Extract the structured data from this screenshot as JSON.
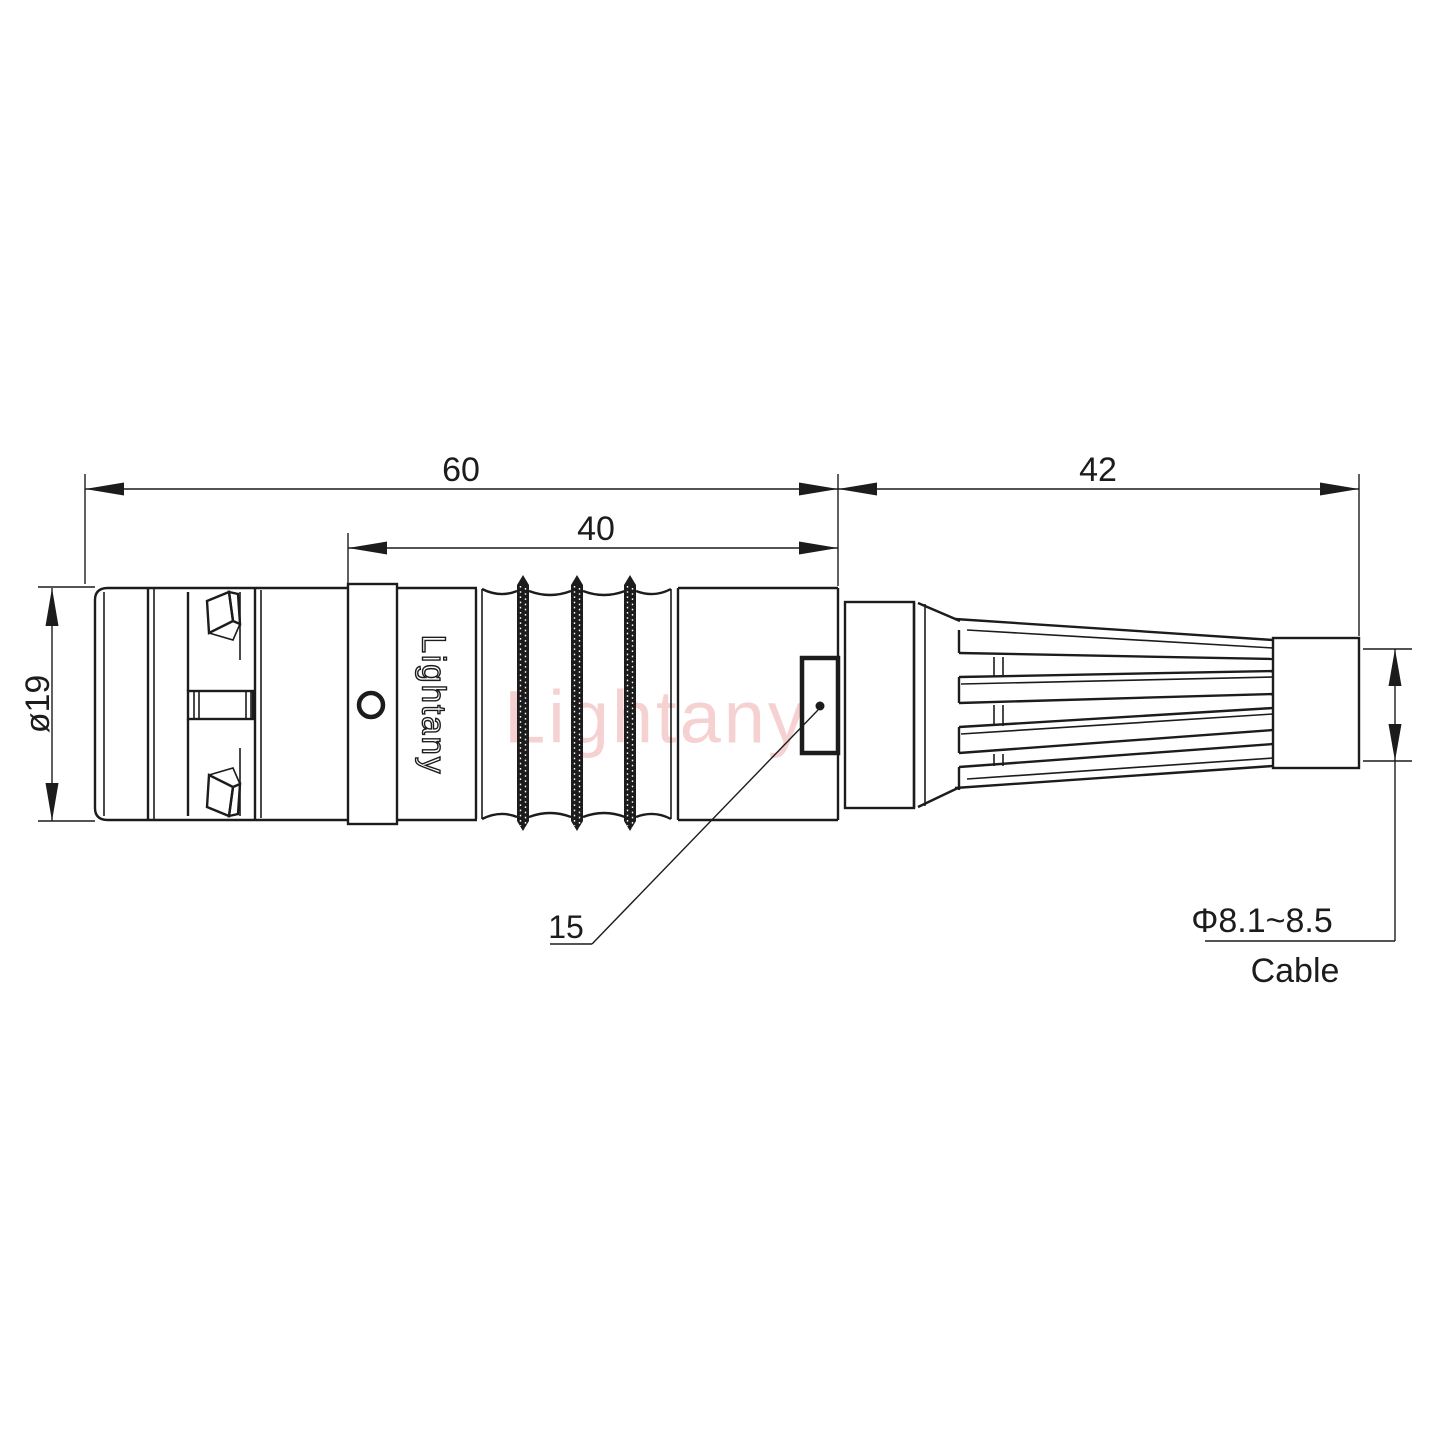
{
  "drawing": {
    "brand_watermark": "Lightany",
    "body_engraving": "Lightany",
    "dimensions": {
      "overall_length": "60",
      "mid_length": "40",
      "boot_length": "42",
      "shell_diameter": "ø19",
      "keyway_callout": "15",
      "cable_diameter_range": "Φ8.1~8.5",
      "cable_label": "Cable"
    },
    "colors": {
      "line": "#1c1c1c",
      "background": "#ffffff",
      "knurl_fill": "#111111",
      "watermark_pink": "#e57373"
    }
  }
}
